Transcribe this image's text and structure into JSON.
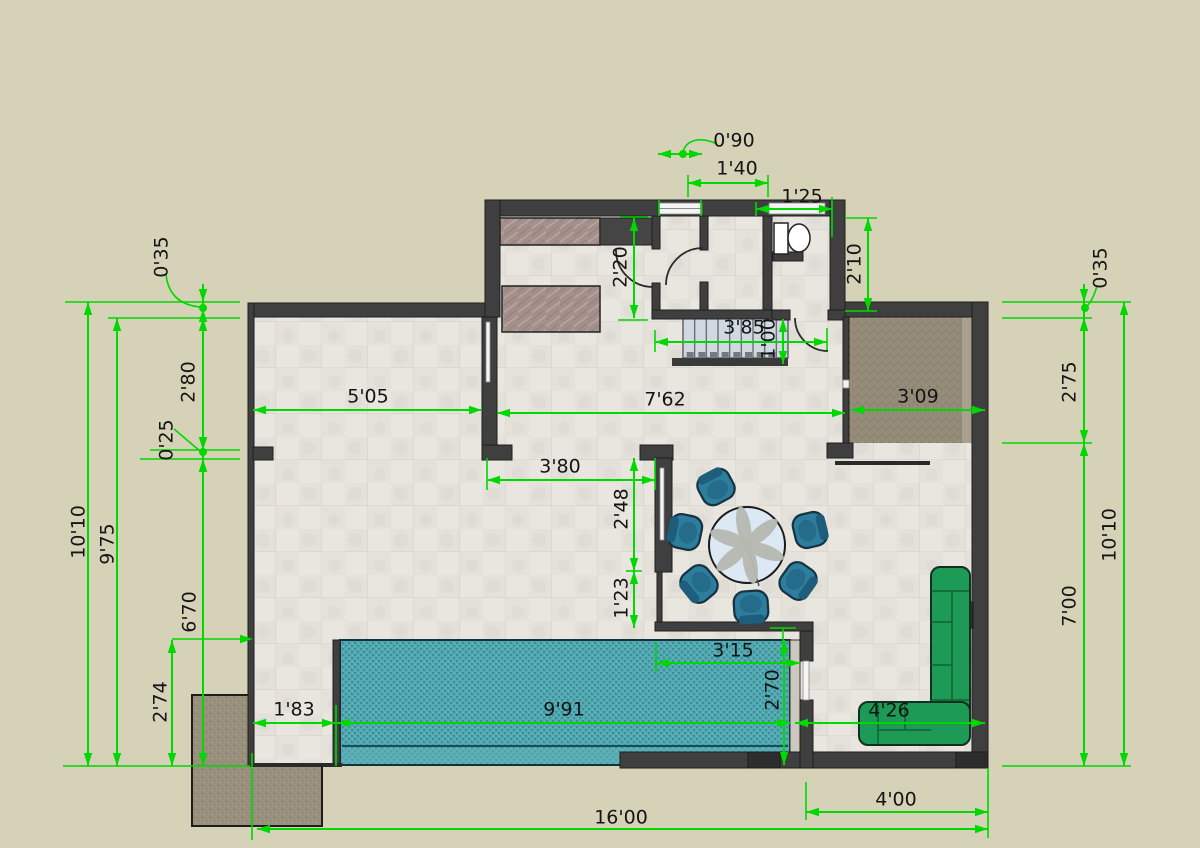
{
  "drawing": {
    "type": "architectural-floor-plan",
    "units": "metric-style feet'inches labels",
    "colors": {
      "background": "#d6d2b8",
      "wall": "#3f3f3f",
      "floor": "#e9e6df",
      "pool": "#53a9b1",
      "pool_dark": "#3d8d96",
      "terrace": "#948a78",
      "patio": "#99907e",
      "counter": "#a4908a",
      "stairs": "#d0d8e2",
      "dimension_green": "#00d800",
      "sofa_green": "#1d9a55",
      "chair_teal": "#2d7d9d",
      "table_blue": "#dce8f4"
    }
  },
  "dimensions": [
    {
      "id": "dim-0-90",
      "label": "0'90",
      "x1": 658,
      "y1": 154,
      "x2": 702,
      "y2": 154,
      "lx": 734,
      "ly": 141,
      "rot": 0,
      "style": "out"
    },
    {
      "id": "dim-1-40",
      "label": "1'40",
      "x1": 688,
      "y1": 183,
      "x2": 768,
      "y2": 183,
      "lx": 737,
      "ly": 169,
      "rot": 0,
      "style": "out"
    },
    {
      "id": "dim-1-25",
      "label": "1'25",
      "x1": 756,
      "y1": 209,
      "x2": 832,
      "y2": 209,
      "lx": 802,
      "ly": 197,
      "rot": 0,
      "style": "out"
    },
    {
      "id": "dim-2-10",
      "label": "2'10",
      "x1": 868,
      "y1": 218,
      "x2": 868,
      "y2": 311,
      "lx": 855,
      "ly": 264,
      "rot": -90,
      "style": "out"
    },
    {
      "id": "dim-2-20",
      "label": "2'20",
      "x1": 634,
      "y1": 218,
      "x2": 634,
      "y2": 318,
      "lx": 621,
      "ly": 267,
      "rot": -90,
      "style": "out"
    },
    {
      "id": "dim-3-85",
      "label": "3'85",
      "x1": 655,
      "y1": 342,
      "x2": 827,
      "y2": 342,
      "lx": 744,
      "ly": 328,
      "rot": 0,
      "style": "out"
    },
    {
      "id": "dim-1-00",
      "label": "1'00",
      "x1": 783,
      "y1": 319,
      "x2": 783,
      "y2": 364,
      "lx": 769,
      "ly": 339,
      "rot": -90,
      "style": "out"
    },
    {
      "id": "dim-0-35-left",
      "label": "0'35",
      "x1": 203,
      "y1": 302,
      "x2": 203,
      "y2": 318,
      "lx": 162,
      "ly": 257,
      "rot": -90,
      "style": "in"
    },
    {
      "id": "dim-2-80",
      "label": "2'80",
      "x1": 203,
      "y1": 309,
      "x2": 203,
      "y2": 450,
      "lx": 189,
      "ly": 382,
      "rot": -90,
      "style": "out"
    },
    {
      "id": "dim-0-25",
      "label": "0'25",
      "x1": 203,
      "y1": 450,
      "x2": 203,
      "y2": 459,
      "lx": 167,
      "ly": 440,
      "rot": -90,
      "style": "in"
    },
    {
      "id": "dim-10-10-left",
      "label": "10'10",
      "x1": 88,
      "y1": 302,
      "x2": 88,
      "y2": 766,
      "lx": 79,
      "ly": 532,
      "rot": -90,
      "style": "out"
    },
    {
      "id": "dim-9-75",
      "label": "9'75",
      "x1": 117,
      "y1": 318,
      "x2": 117,
      "y2": 766,
      "lx": 108,
      "ly": 544,
      "rot": -90,
      "style": "out"
    },
    {
      "id": "dim-6-70",
      "label": "6'70",
      "x1": 203,
      "y1": 459,
      "x2": 203,
      "y2": 766,
      "lx": 190,
      "ly": 612,
      "rot": -90,
      "style": "out"
    },
    {
      "id": "dim-2-74",
      "label": "2'74",
      "x1": 172,
      "y1": 640,
      "x2": 172,
      "y2": 766,
      "lx": 161,
      "ly": 702,
      "rot": -90,
      "style": "out"
    },
    {
      "id": "dim-5-05",
      "label": "5'05",
      "x1": 253,
      "y1": 410,
      "x2": 482,
      "y2": 410,
      "lx": 368,
      "ly": 397,
      "rot": 0,
      "style": "out"
    },
    {
      "id": "dim-7-62",
      "label": "7'62",
      "x1": 497,
      "y1": 413,
      "x2": 845,
      "y2": 413,
      "lx": 665,
      "ly": 400,
      "rot": 0,
      "style": "out"
    },
    {
      "id": "dim-3-09",
      "label": "3'09",
      "x1": 851,
      "y1": 410,
      "x2": 985,
      "y2": 410,
      "lx": 918,
      "ly": 397,
      "rot": 0,
      "style": "out"
    },
    {
      "id": "dim-3-80",
      "label": "3'80",
      "x1": 487,
      "y1": 480,
      "x2": 655,
      "y2": 480,
      "lx": 560,
      "ly": 467,
      "rot": 0,
      "style": "out"
    },
    {
      "id": "dim-2-48",
      "label": "2'48",
      "x1": 634,
      "y1": 458,
      "x2": 634,
      "y2": 571,
      "lx": 622,
      "ly": 509,
      "rot": -90,
      "style": "out"
    },
    {
      "id": "dim-1-23",
      "label": "1'23",
      "x1": 634,
      "y1": 571,
      "x2": 634,
      "y2": 628,
      "lx": 622,
      "ly": 598,
      "rot": -90,
      "style": "out"
    },
    {
      "id": "dim-3-15",
      "label": "3'15",
      "x1": 656,
      "y1": 663,
      "x2": 800,
      "y2": 663,
      "lx": 733,
      "ly": 651,
      "rot": 0,
      "style": "out"
    },
    {
      "id": "dim-1-83",
      "label": "1'83",
      "x1": 253,
      "y1": 723,
      "x2": 335,
      "y2": 723,
      "lx": 294,
      "ly": 710,
      "rot": 0,
      "style": "out"
    },
    {
      "id": "dim-9-91",
      "label": "9'91",
      "x1": 337,
      "y1": 723,
      "x2": 790,
      "y2": 723,
      "lx": 564,
      "ly": 710,
      "rot": 0,
      "style": "out"
    },
    {
      "id": "dim-2-70",
      "label": "2'70",
      "x1": 784,
      "y1": 640,
      "x2": 784,
      "y2": 765,
      "lx": 773,
      "ly": 690,
      "rot": -90,
      "style": "out"
    },
    {
      "id": "dim-4-26",
      "label": "4'26",
      "x1": 795,
      "y1": 723,
      "x2": 985,
      "y2": 723,
      "lx": 889,
      "ly": 711,
      "rot": 0,
      "style": "out"
    },
    {
      "id": "dim-0-35-right",
      "label": "0'35",
      "x1": 1084,
      "y1": 302,
      "x2": 1084,
      "y2": 318,
      "lx": 1101,
      "ly": 268,
      "rot": -90,
      "style": "in"
    },
    {
      "id": "dim-2-75",
      "label": "2'75",
      "x1": 1084,
      "y1": 318,
      "x2": 1084,
      "y2": 443,
      "lx": 1070,
      "ly": 382,
      "rot": -90,
      "style": "out"
    },
    {
      "id": "dim-10-10-right",
      "label": "10'10",
      "x1": 1124,
      "y1": 302,
      "x2": 1124,
      "y2": 766,
      "lx": 1110,
      "ly": 535,
      "rot": -90,
      "style": "out"
    },
    {
      "id": "dim-7-00",
      "label": "7'00",
      "x1": 1084,
      "y1": 443,
      "x2": 1084,
      "y2": 766,
      "lx": 1070,
      "ly": 606,
      "rot": -90,
      "style": "out"
    },
    {
      "id": "dim-4-00",
      "label": "4'00",
      "x1": 806,
      "y1": 812,
      "x2": 988,
      "y2": 812,
      "lx": 896,
      "ly": 800,
      "rot": 0,
      "style": "out"
    },
    {
      "id": "dim-16-00",
      "label": "16'00",
      "x1": 257,
      "y1": 829,
      "x2": 988,
      "y2": 829,
      "lx": 621,
      "ly": 818,
      "rot": 0,
      "style": "out"
    }
  ],
  "extension_lines": [
    [
      65,
      302,
      240,
      302
    ],
    [
      108,
      318,
      240,
      318
    ],
    [
      150,
      450,
      240,
      450
    ],
    [
      140,
      459,
      240,
      459
    ],
    [
      172,
      639,
      250,
      639
    ],
    [
      63,
      766,
      250,
      766
    ],
    [
      1002,
      302,
      1131,
      302
    ],
    [
      1002,
      318,
      1092,
      318
    ],
    [
      1002,
      443,
      1092,
      443
    ],
    [
      1002,
      766,
      1131,
      766
    ],
    [
      845,
      218,
      877,
      218
    ],
    [
      845,
      311,
      877,
      311
    ],
    [
      620,
      217,
      648,
      217
    ],
    [
      618,
      320,
      648,
      320
    ],
    [
      659,
      200,
      659,
      216
    ],
    [
      701,
      200,
      701,
      216
    ],
    [
      688,
      175,
      688,
      197
    ],
    [
      768,
      175,
      768,
      197
    ],
    [
      756,
      202,
      756,
      216
    ],
    [
      832,
      197,
      832,
      237
    ],
    [
      655,
      330,
      655,
      352
    ],
    [
      827,
      328,
      827,
      350
    ],
    [
      487,
      458,
      487,
      490
    ],
    [
      655,
      458,
      655,
      490
    ],
    [
      626,
      571,
      642,
      571
    ],
    [
      656,
      642,
      656,
      672
    ],
    [
      783,
      628,
      783,
      658
    ],
    [
      770,
      628,
      796,
      628
    ],
    [
      336,
      705,
      336,
      766
    ],
    [
      252,
      753,
      252,
      840
    ],
    [
      806,
      782,
      806,
      820
    ],
    [
      988,
      768,
      988,
      838
    ]
  ],
  "leader_dots": [
    [
      683,
      154
    ],
    [
      203,
      308
    ],
    [
      203,
      452
    ],
    [
      1085,
      308
    ]
  ],
  "leader_paths": [
    "M717,144 C700,136 686,140 683,152",
    "M166,274 C168,295 180,305 200,307",
    "M174,429 L200,451",
    "M1097,286 C1093,300 1089,304 1086,307"
  ],
  "extra_arrows": [
    {
      "x": 253,
      "y": 639,
      "dx": 1,
      "dy": 0
    }
  ],
  "furniture": {
    "dining_table": {
      "cx": 747,
      "cy": 545,
      "r": 38,
      "petals": 6,
      "petal_radius": 19,
      "petal_rx": 20,
      "petal_ry": 7
    },
    "dining_chairs": [
      [
        716,
        487
      ],
      [
        685,
        532
      ],
      [
        699,
        584
      ],
      [
        751,
        607
      ],
      [
        798,
        581
      ],
      [
        810,
        530
      ]
    ],
    "stairs": {
      "x": 683,
      "y": 318,
      "w": 105,
      "h": 40,
      "treads": 9
    }
  }
}
